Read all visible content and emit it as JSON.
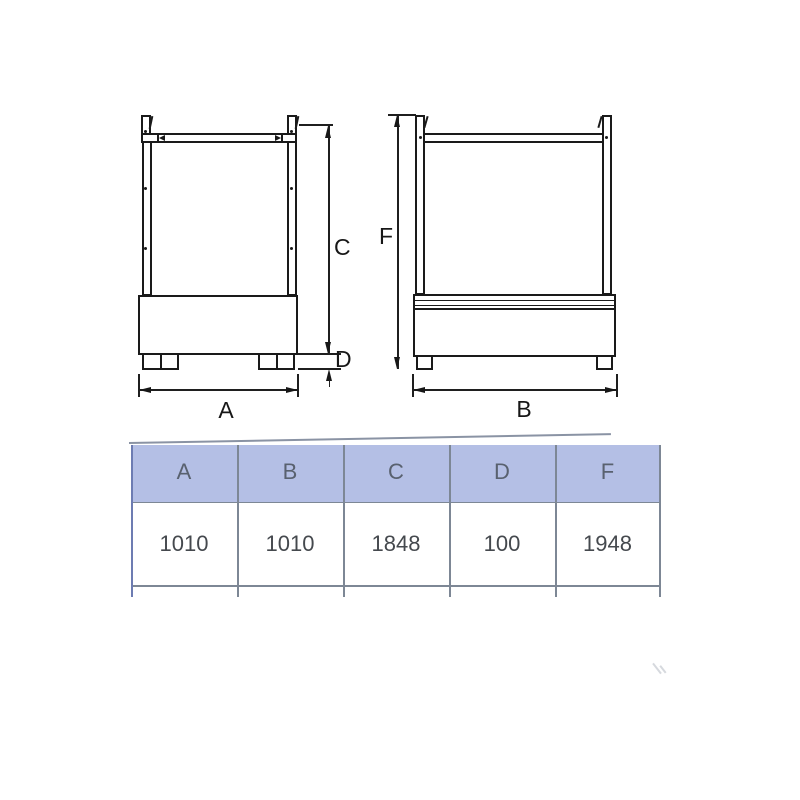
{
  "page": {
    "background": "#ffffff"
  },
  "drawing": {
    "front_view": {
      "width_label": "A",
      "height_label": "C",
      "feet_height_label": "D"
    },
    "side_view": {
      "width_label": "B",
      "height_label": "F"
    }
  },
  "table": {
    "columns": [
      "A",
      "B",
      "C",
      "D",
      "F"
    ],
    "values": [
      "1010",
      "1010",
      "1848",
      "100",
      "1948"
    ],
    "header_fill": "#b4bfe5",
    "header_text_color": "#59616f",
    "value_text_color": "#45494e",
    "grid_color": "#7d8795"
  },
  "colors": {
    "drawing_line": "#1a1a1a"
  }
}
